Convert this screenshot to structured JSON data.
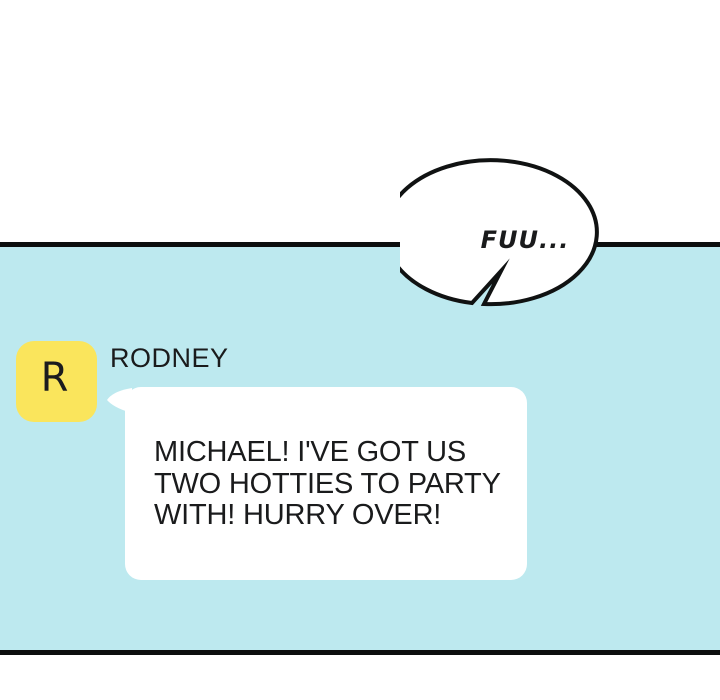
{
  "colors": {
    "panel_bg": "#bde9ef",
    "avatar_bg": "#fae55c",
    "bubble_bg": "#ffffff",
    "border": "#0c0e0e",
    "text": "#1a1b1c"
  },
  "speech_bubble": {
    "text": "FUU..."
  },
  "chat": {
    "sender": {
      "avatar_letter": "R",
      "name": "RODNEY"
    },
    "message": {
      "lines": [
        "MICHAEL! I'VE GOT US",
        "TWO HOTTIES TO PARTY",
        "WITH! HURRY OVER!"
      ]
    }
  }
}
